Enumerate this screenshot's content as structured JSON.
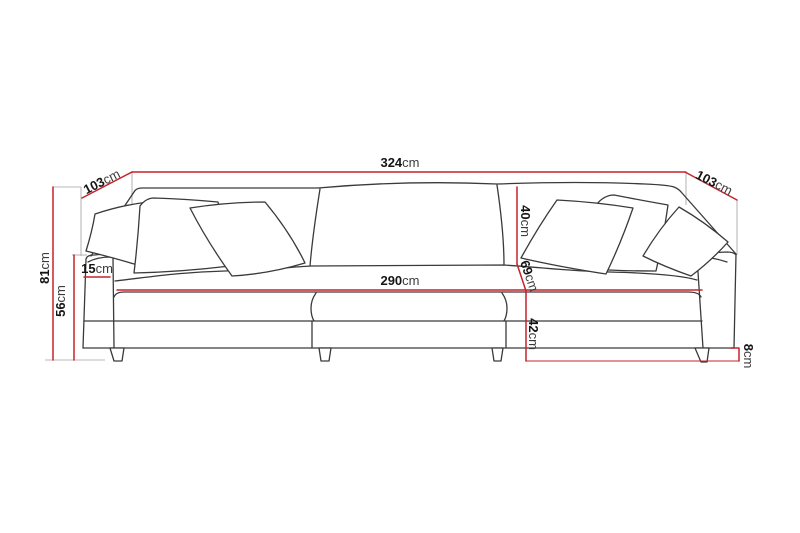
{
  "diagram": {
    "type": "furniture-dimension-drawing",
    "subject": "three-seat-sofa-front-view",
    "unit": "cm",
    "colors": {
      "dimension_line": "#c4232b",
      "sofa_outline": "#3a3a3a",
      "witness_line": "#b8b8b8",
      "label_value": "#151515",
      "label_unit": "#3c3c3c",
      "background": "#ffffff"
    },
    "dimensions": [
      {
        "name": "overall-width",
        "value": "324",
        "unit": "cm"
      },
      {
        "name": "depth-left",
        "value": "103",
        "unit": "cm"
      },
      {
        "name": "depth-right",
        "value": "103",
        "unit": "cm"
      },
      {
        "name": "overall-height",
        "value": "81",
        "unit": "cm"
      },
      {
        "name": "arm-height",
        "value": "56",
        "unit": "cm"
      },
      {
        "name": "arm-width",
        "value": "15",
        "unit": "cm"
      },
      {
        "name": "seat-width",
        "value": "290",
        "unit": "cm"
      },
      {
        "name": "back-cushion-height",
        "value": "40",
        "unit": "cm"
      },
      {
        "name": "seat-depth",
        "value": "69",
        "unit": "cm"
      },
      {
        "name": "seat-height",
        "value": "42",
        "unit": "cm"
      },
      {
        "name": "leg-height",
        "value": "8",
        "unit": "cm"
      }
    ]
  }
}
